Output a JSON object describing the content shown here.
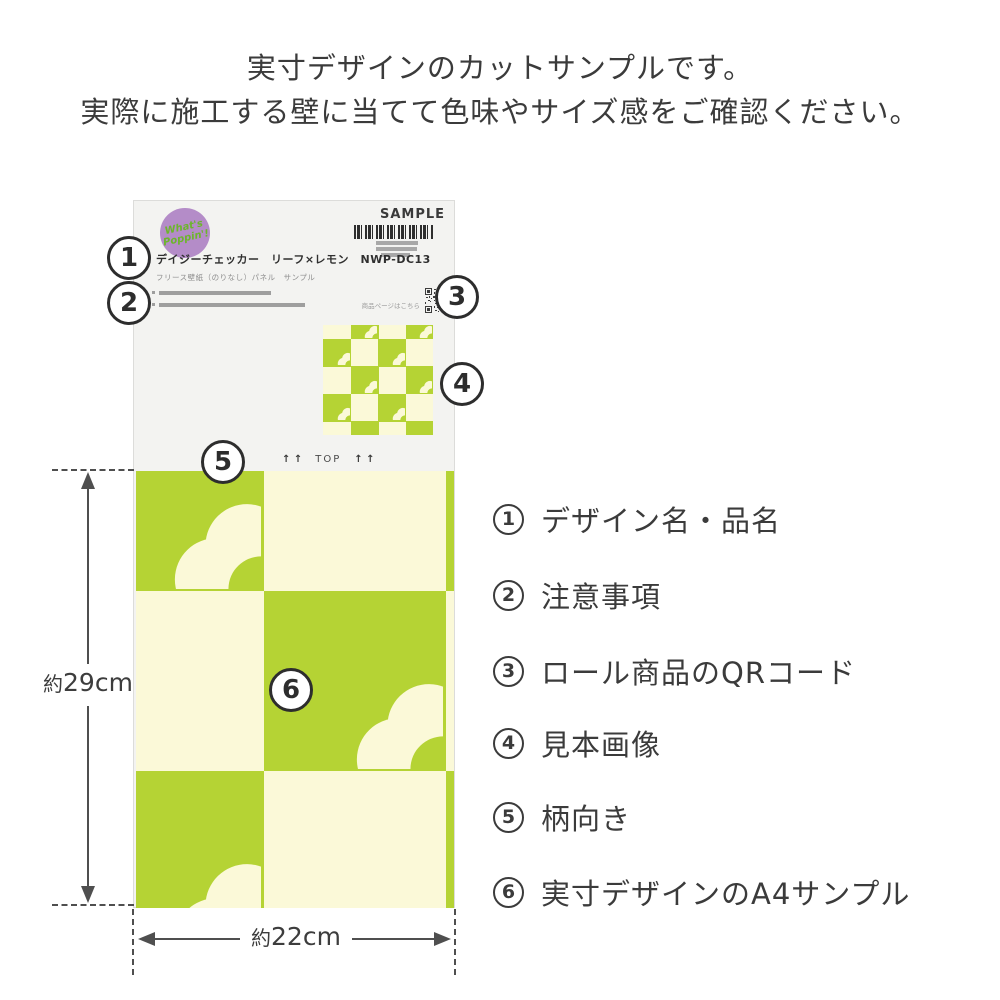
{
  "colors": {
    "green": "#b5d334",
    "cream": "#fbf9d8",
    "card_bg": "#f3f3f1",
    "card_border": "#dcdcda",
    "purple": "#b48cc8",
    "logo_green": "#6db52c",
    "ink": "#3b3b3b",
    "mid_gray": "#a8a8a8",
    "bar_gray": "#9e9e9e",
    "barcode_ink": "#2e2e2e",
    "dim": "#4f4f4f"
  },
  "intro": {
    "line1": "実寸デザインのカットサンプルです。",
    "line2": "実際に施工する壁に当てて色味やサイズ感をご確認ください。"
  },
  "card": {
    "logo": {
      "line1": "What's",
      "line2": "Poppin'!"
    },
    "sample_label": "SAMPLE",
    "product_title": "デイジーチェッカー　リーフ×レモン　NWP-DC13",
    "product_subtitle": "フリース壁紙（のりなし）パネル　サンプル",
    "qr_label": "商品ページはこちら",
    "top_arrows": "↑ ↑",
    "top_label": "TOP"
  },
  "markers": [
    "1",
    "2",
    "3",
    "4",
    "5",
    "6"
  ],
  "legend": {
    "items": [
      {
        "num": "1",
        "label": "デザイン名・品名"
      },
      {
        "num": "2",
        "label": "注意事項"
      },
      {
        "num": "3",
        "label": "ロール商品のQRコード"
      },
      {
        "num": "4",
        "label": "見本画像"
      },
      {
        "num": "5",
        "label": "柄向き"
      },
      {
        "num": "6",
        "label": "実寸デザインのA4サンプル"
      }
    ]
  },
  "dimensions": {
    "height_prefix": "約",
    "height_value": "29cm",
    "width_prefix": "約",
    "width_value": "22cm"
  }
}
